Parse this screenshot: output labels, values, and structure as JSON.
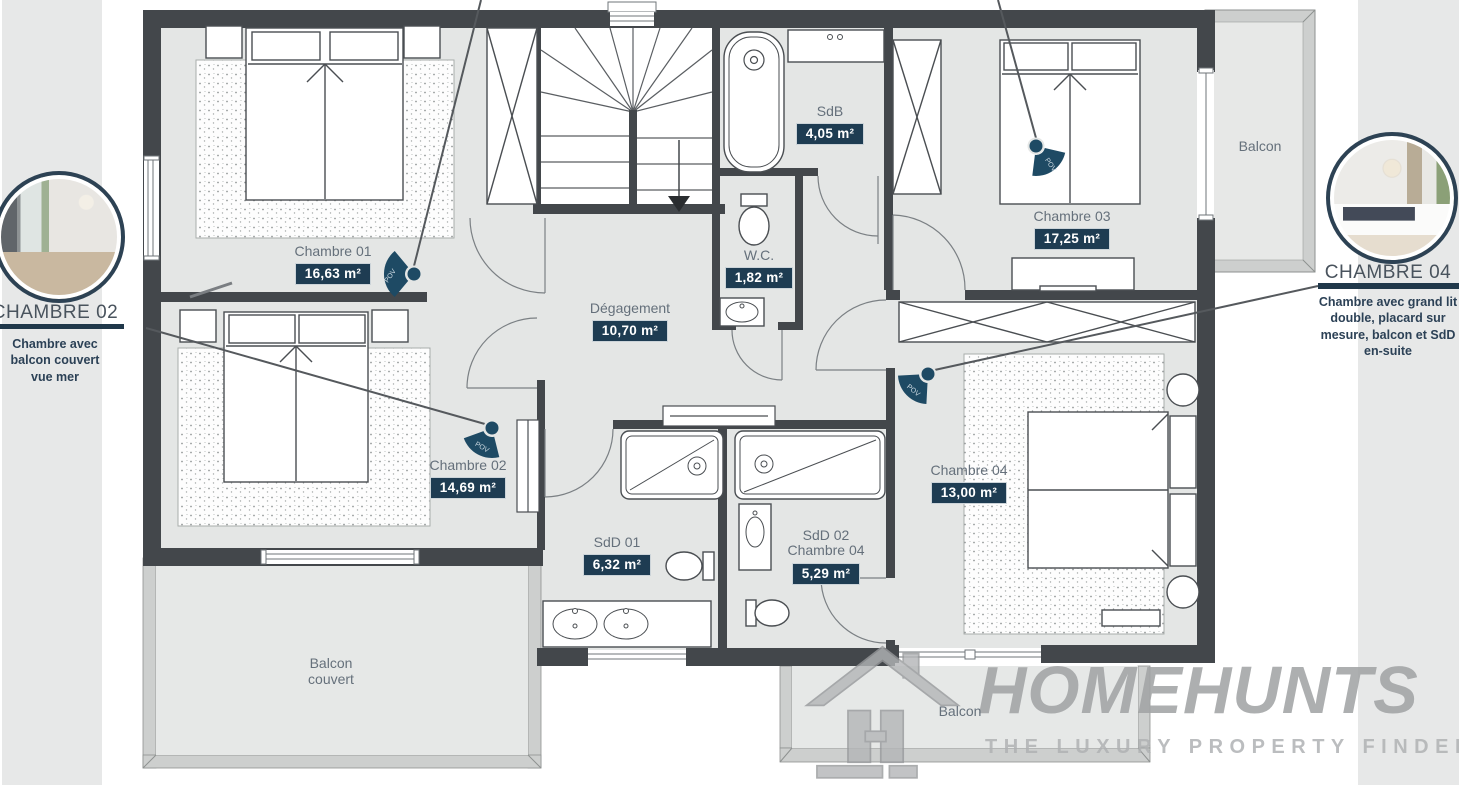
{
  "plan": {
    "floor_type": "floor-plan-first-floor",
    "rooms": [
      {
        "id": "chambre01",
        "label": "Chambre 01",
        "area": "16,63 m²"
      },
      {
        "id": "sdb",
        "label": "SdB",
        "area": "4,05 m²"
      },
      {
        "id": "chambre03",
        "label": "Chambre 03",
        "area": "17,25 m²"
      },
      {
        "id": "wc",
        "label": "W.C.",
        "area": "1,82 m²"
      },
      {
        "id": "degagement",
        "label": "Dégagement",
        "area": "10,70 m²"
      },
      {
        "id": "chambre02",
        "label": "Chambre 02",
        "area": "14,69 m²"
      },
      {
        "id": "chambre04",
        "label": "Chambre 04",
        "area": "13,00 m²"
      },
      {
        "id": "sdd01",
        "label": "SdD 01",
        "area": "6,32 m²"
      },
      {
        "id": "sdd02",
        "label": "SdD 02",
        "sub": "Chambre 04",
        "area": "5,29 m²"
      }
    ],
    "balconies": {
      "top_right": "Balcon",
      "covered_line1": "Balcon",
      "covered_line2": "couvert",
      "bottom": "Balcon"
    },
    "pov_label": "POV"
  },
  "callouts": {
    "left": {
      "title": "CHAMBRE 02",
      "description": "Chambre avec balcon couvert vue mer"
    },
    "right": {
      "title": "CHAMBRE 04",
      "description": "Chambre avec grand lit double, placard sur mesure, balcon et SdD en-suite"
    }
  },
  "logo": {
    "brand": "HOMEHUNTS",
    "tagline": "THE LUXURY PROPERTY FINDERS"
  },
  "colors": {
    "wall": "#43474b",
    "floor": "#e4e6e5",
    "badge_bg": "#1e3c52",
    "accent_rule": "#20384a",
    "pov_icon": "#1e4a64",
    "balcony_rail": "#cdcfce",
    "watermark": "#a2a4a6"
  }
}
